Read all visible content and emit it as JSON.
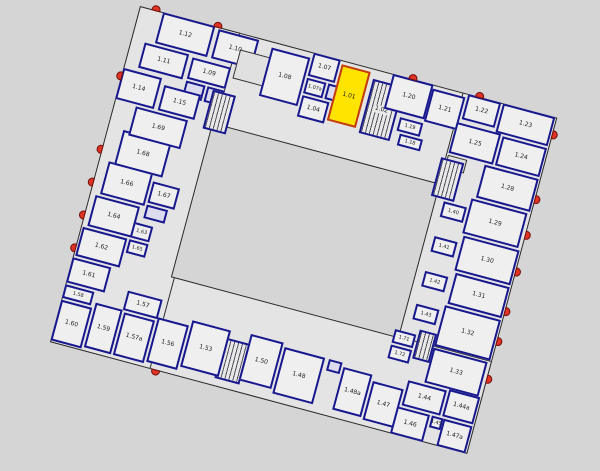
{
  "canvas": {
    "width": 600,
    "height": 471
  },
  "colors": {
    "background": "#d5d5d5",
    "building_body": "#e4e4e4",
    "room_fill": "#efefef",
    "wall": "#18188e",
    "outline": "#2a2a2a",
    "highlight": "#ffe400",
    "highlight_border": "#c23b16",
    "door_marker": "#e03326",
    "stair_hatch": "#50505a"
  },
  "plan": {
    "origin": {
      "left": 140,
      "top": 6
    },
    "rotation_deg": 15,
    "size": {
      "w": 432,
      "h": 348
    },
    "selected_room": "1.01",
    "slabs": [
      {
        "name": "top",
        "x": 0,
        "y": 0,
        "w": 432,
        "h": 96
      },
      {
        "name": "right",
        "x": 334,
        "y": 0,
        "w": 98,
        "h": 348
      },
      {
        "name": "bottom",
        "x": 0,
        "y": 252,
        "w": 432,
        "h": 96
      },
      {
        "name": "left",
        "x": 0,
        "y": 0,
        "w": 104,
        "h": 348
      }
    ],
    "courtyard": {
      "x": 100,
      "y": 94,
      "w": 236,
      "h": 160
    },
    "rooms": [
      {
        "label": "1.12",
        "x": 24,
        "y": 0,
        "w": 54,
        "h": 32,
        "kind": "n"
      },
      {
        "label": "1.10",
        "x": 82,
        "y": 2,
        "w": 42,
        "h": 30,
        "kind": "n"
      },
      {
        "label": "1.11",
        "x": 14,
        "y": 34,
        "w": 46,
        "h": 26,
        "kind": "n"
      },
      {
        "label": "1.09",
        "x": 64,
        "y": 36,
        "w": 40,
        "h": 22,
        "kind": "n"
      },
      {
        "label": "",
        "x": 64,
        "y": 60,
        "w": 20,
        "h": 16,
        "kind": "w"
      },
      {
        "label": "",
        "x": 86,
        "y": 60,
        "w": 18,
        "h": 16,
        "kind": "w"
      },
      {
        "label": "1.14",
        "x": 0,
        "y": 64,
        "w": 40,
        "h": 32,
        "kind": "n"
      },
      {
        "label": "1.15",
        "x": 44,
        "y": 70,
        "w": 38,
        "h": 26,
        "kind": "n"
      },
      {
        "label": "",
        "x": 108,
        "y": 16,
        "w": 34,
        "h": 30,
        "kind": "v"
      },
      {
        "label": "",
        "x": 92,
        "y": 62,
        "w": 24,
        "h": 40,
        "kind": "s"
      },
      {
        "label": "1.08",
        "x": 138,
        "y": 6,
        "w": 40,
        "h": 50,
        "kind": "n"
      },
      {
        "label": "1.07",
        "x": 180,
        "y": 0,
        "w": 28,
        "h": 24,
        "kind": "n"
      },
      {
        "label": "1.07a",
        "x": 180,
        "y": 26,
        "w": 20,
        "h": 16,
        "kind": "n"
      },
      {
        "label": "",
        "x": 202,
        "y": 26,
        "w": 12,
        "h": 16,
        "kind": "w"
      },
      {
        "label": "1.04",
        "x": 180,
        "y": 44,
        "w": 28,
        "h": 22,
        "kind": "n"
      },
      {
        "label": "1.01",
        "x": 210,
        "y": 4,
        "w": 30,
        "h": 58,
        "kind": "h"
      },
      {
        "label": "1.02",
        "x": 244,
        "y": 10,
        "w": 32,
        "h": 56,
        "kind": "s"
      },
      {
        "label": "1.20",
        "x": 262,
        "y": 0,
        "w": 42,
        "h": 36,
        "kind": "n"
      },
      {
        "label": "1.19",
        "x": 280,
        "y": 40,
        "w": 24,
        "h": 14,
        "kind": "n"
      },
      {
        "label": "1.18",
        "x": 284,
        "y": 56,
        "w": 24,
        "h": 12,
        "kind": "n"
      },
      {
        "label": "1.21",
        "x": 304,
        "y": 4,
        "w": 34,
        "h": 34,
        "kind": "n"
      },
      {
        "label": "1.22",
        "x": 340,
        "y": 0,
        "w": 34,
        "h": 26,
        "kind": "n"
      },
      {
        "label": "1.23",
        "x": 376,
        "y": 0,
        "w": 54,
        "h": 30,
        "kind": "n"
      },
      {
        "label": "1.25",
        "x": 336,
        "y": 30,
        "w": 46,
        "h": 32,
        "kind": "n"
      },
      {
        "label": "1.24",
        "x": 384,
        "y": 32,
        "w": 46,
        "h": 30,
        "kind": "n"
      },
      {
        "label": "",
        "x": 336,
        "y": 64,
        "w": 20,
        "h": 14,
        "kind": "v"
      },
      {
        "label": "",
        "x": 330,
        "y": 68,
        "w": 24,
        "h": 40,
        "kind": "s"
      },
      {
        "label": "1.28",
        "x": 374,
        "y": 64,
        "w": 56,
        "h": 34,
        "kind": "n"
      },
      {
        "label": "1.29",
        "x": 370,
        "y": 100,
        "w": 58,
        "h": 36,
        "kind": "n"
      },
      {
        "label": "1.40",
        "x": 344,
        "y": 110,
        "w": 24,
        "h": 16,
        "kind": "n"
      },
      {
        "label": "1.30",
        "x": 372,
        "y": 138,
        "w": 58,
        "h": 36,
        "kind": "n"
      },
      {
        "label": "1.41",
        "x": 344,
        "y": 146,
        "w": 24,
        "h": 16,
        "kind": "n"
      },
      {
        "label": "1.31",
        "x": 374,
        "y": 176,
        "w": 56,
        "h": 32,
        "kind": "n"
      },
      {
        "label": "1.42",
        "x": 344,
        "y": 182,
        "w": 24,
        "h": 16,
        "kind": "n"
      },
      {
        "label": "1.32",
        "x": 372,
        "y": 210,
        "w": 58,
        "h": 42,
        "kind": "n"
      },
      {
        "label": "1.43",
        "x": 344,
        "y": 216,
        "w": 24,
        "h": 16,
        "kind": "n"
      },
      {
        "label": "1.33",
        "x": 372,
        "y": 254,
        "w": 56,
        "h": 36,
        "kind": "n"
      },
      {
        "label": "1.71",
        "x": 330,
        "y": 246,
        "w": 22,
        "h": 14,
        "kind": "n"
      },
      {
        "label": "1.72",
        "x": 330,
        "y": 262,
        "w": 22,
        "h": 14,
        "kind": "n"
      },
      {
        "label": "",
        "x": 354,
        "y": 240,
        "w": 18,
        "h": 30,
        "kind": "s"
      },
      {
        "label": "1.44",
        "x": 356,
        "y": 292,
        "w": 40,
        "h": 26,
        "kind": "n"
      },
      {
        "label": "1.44a",
        "x": 398,
        "y": 290,
        "w": 32,
        "h": 28,
        "kind": "n"
      },
      {
        "label": "1.45",
        "x": 388,
        "y": 320,
        "w": 12,
        "h": 12,
        "kind": "n"
      },
      {
        "label": "1.46",
        "x": 352,
        "y": 320,
        "w": 34,
        "h": 28,
        "kind": "n"
      },
      {
        "label": "1.47a",
        "x": 400,
        "y": 320,
        "w": 30,
        "h": 28,
        "kind": "n"
      },
      {
        "label": "1.47",
        "x": 322,
        "y": 302,
        "w": 32,
        "h": 40,
        "kind": "n"
      },
      {
        "label": "1.48a",
        "x": 290,
        "y": 296,
        "w": 30,
        "h": 44,
        "kind": "n"
      },
      {
        "label": "",
        "x": 274,
        "y": 292,
        "w": 14,
        "h": 12,
        "kind": "w"
      },
      {
        "label": "1.48",
        "x": 228,
        "y": 292,
        "w": 42,
        "h": 48,
        "kind": "n"
      },
      {
        "label": "1.50",
        "x": 192,
        "y": 288,
        "w": 34,
        "h": 48,
        "kind": "n"
      },
      {
        "label": "",
        "x": 168,
        "y": 298,
        "w": 26,
        "h": 42,
        "kind": "s"
      },
      {
        "label": "1.53",
        "x": 132,
        "y": 290,
        "w": 40,
        "h": 48,
        "kind": "n"
      },
      {
        "label": "1.56",
        "x": 98,
        "y": 296,
        "w": 32,
        "h": 46,
        "kind": "n"
      },
      {
        "label": "1.57",
        "x": 62,
        "y": 278,
        "w": 36,
        "h": 20,
        "kind": "n"
      },
      {
        "label": "1.57a",
        "x": 64,
        "y": 300,
        "w": 32,
        "h": 44,
        "kind": "n"
      },
      {
        "label": "1.59",
        "x": 34,
        "y": 298,
        "w": 28,
        "h": 46,
        "kind": "n"
      },
      {
        "label": "1.58",
        "x": 0,
        "y": 288,
        "w": 30,
        "h": 14,
        "kind": "n"
      },
      {
        "label": "1.60",
        "x": 0,
        "y": 304,
        "w": 32,
        "h": 42,
        "kind": "n"
      },
      {
        "label": "1.61",
        "x": 0,
        "y": 260,
        "w": 40,
        "h": 26,
        "kind": "n"
      },
      {
        "label": "1.62",
        "x": 2,
        "y": 228,
        "w": 46,
        "h": 30,
        "kind": "n"
      },
      {
        "label": "1.63",
        "x": 50,
        "y": 210,
        "w": 20,
        "h": 16,
        "kind": "n"
      },
      {
        "label": "1.65",
        "x": 50,
        "y": 228,
        "w": 20,
        "h": 14,
        "kind": "n"
      },
      {
        "label": "1.64",
        "x": 6,
        "y": 194,
        "w": 46,
        "h": 32,
        "kind": "n"
      },
      {
        "label": "1.66",
        "x": 10,
        "y": 158,
        "w": 46,
        "h": 34,
        "kind": "n"
      },
      {
        "label": "1.67",
        "x": 58,
        "y": 166,
        "w": 28,
        "h": 22,
        "kind": "n"
      },
      {
        "label": "",
        "x": 58,
        "y": 190,
        "w": 22,
        "h": 14,
        "kind": "w"
      },
      {
        "label": "1.68",
        "x": 16,
        "y": 124,
        "w": 50,
        "h": 36,
        "kind": "n"
      },
      {
        "label": "1.69",
        "x": 22,
        "y": 98,
        "w": 54,
        "h": 30,
        "kind": "n"
      }
    ],
    "doors": [
      {
        "edge": "top",
        "pos": 12
      },
      {
        "edge": "top",
        "pos": 76
      },
      {
        "edge": "top",
        "pos": 278
      },
      {
        "edge": "top",
        "pos": 347
      },
      {
        "edge": "right",
        "pos": 13
      },
      {
        "edge": "right",
        "pos": 80
      },
      {
        "edge": "right",
        "pos": 117
      },
      {
        "edge": "right",
        "pos": 155
      },
      {
        "edge": "right",
        "pos": 196
      },
      {
        "edge": "right",
        "pos": 227
      },
      {
        "edge": "right",
        "pos": 266
      },
      {
        "edge": "left",
        "pos": 68
      },
      {
        "edge": "left",
        "pos": 144
      },
      {
        "edge": "left",
        "pos": 178
      },
      {
        "edge": "left",
        "pos": 212
      },
      {
        "edge": "left",
        "pos": 246
      },
      {
        "edge": "bottom",
        "pos": 105
      }
    ]
  }
}
